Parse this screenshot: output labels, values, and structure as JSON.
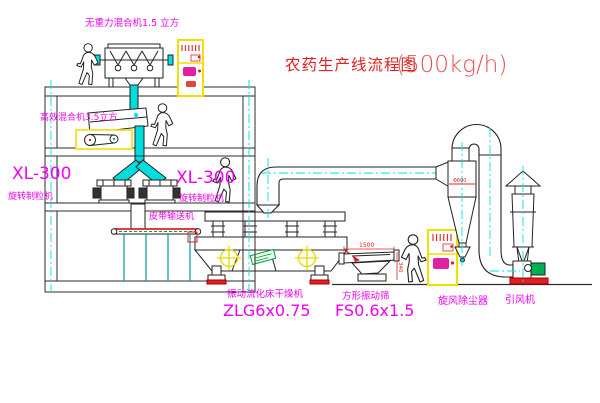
{
  "title": {
    "name": "农药生产线流程图",
    "capacity": "(500kg/h)"
  },
  "labels": {
    "top_mixer": "无重力混合机1.5 立方",
    "floor2_mixer": "高效混合机3.5立方",
    "granulator_left_model": "XL-300",
    "granulator_left_name": "旋转制粒机",
    "granulator_mid_model": "XL-300",
    "granulator_mid_name": "旋转制粒机",
    "belt_conveyor": "皮带输送机",
    "dryer_name": "振动流化床干燥机",
    "dryer_model": "ZLG6x0.75",
    "screen_name": "方形振动筛",
    "screen_model": "FS0.6x1.5",
    "cyclone_name": "旋风除尘器",
    "fan_name": "引风机"
  },
  "dimensions": {
    "screen_length": "1500",
    "screen_side": "340",
    "cyclone_inlet": "Φ600"
  },
  "colors": {
    "line": "#2b2b2b",
    "structure_yellow": "#f0e000",
    "centerline_cyan": "#00e0e0",
    "label_magenta": "#f000f0",
    "accent_red": "#e02020",
    "tag_green": "#00a040"
  }
}
